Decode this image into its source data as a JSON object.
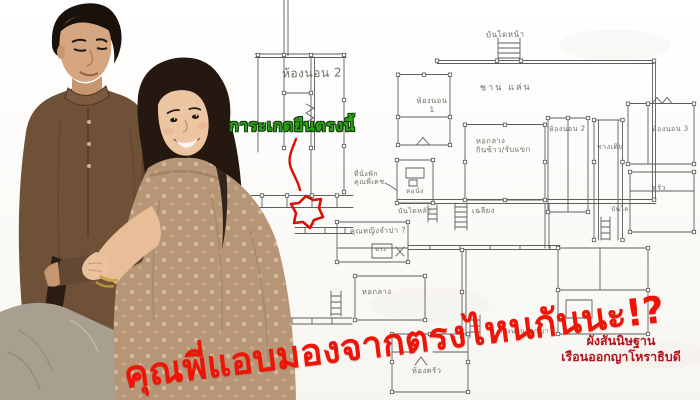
{
  "meme": {
    "caption": "คุณพี่แอบมองจากตรงไหนกันนะ!?",
    "spot_annotation": "การะเกดยืนตรงนี้",
    "credit": {
      "line1": "ผังสันนิษฐาน",
      "line2": "เรือนออกญาโหราธิบดี"
    }
  },
  "colors": {
    "caption_red": "#ee1407",
    "annotation_green": "#2fa316",
    "credit_dark_red": "#b4121b",
    "plan_ink": "#5e5e5e",
    "marker_red": "#d41108"
  },
  "floor_plan": {
    "labels": [
      {
        "text": "ห้องนอน 2",
        "x": 282,
        "y": 66,
        "s": 12
      },
      {
        "text": "บันไดหน้า",
        "x": 486,
        "y": 30,
        "s": 8
      },
      {
        "text": "ชาน แล่น",
        "x": 480,
        "y": 83,
        "s": 9,
        "ls": 2
      },
      {
        "text": "ห้องนอน\n1",
        "x": 414,
        "y": 96,
        "s": 7.5,
        "w": 36,
        "align": "center"
      },
      {
        "text": "หอกลาง\nกินข้าว/รับแขก",
        "x": 476,
        "y": 136,
        "s": 7.5
      },
      {
        "text": "ห้องนอน 2",
        "x": 549,
        "y": 125,
        "s": 7
      },
      {
        "text": "ทางเดิน",
        "x": 597,
        "y": 143,
        "s": 7
      },
      {
        "text": "ห้องนอน 3",
        "x": 652,
        "y": 125,
        "s": 7
      },
      {
        "text": "ครัว",
        "x": 652,
        "y": 184,
        "s": 7
      },
      {
        "text": "เฉลียง",
        "x": 472,
        "y": 206,
        "s": 7.5
      },
      {
        "text": "บันไดหลัง",
        "x": 398,
        "y": 207,
        "s": 7
      },
      {
        "text": "ที่นั่งพัก\nคุณพี่เดช",
        "x": 354,
        "y": 170,
        "s": 7
      },
      {
        "text": "หอนั่ง",
        "x": 406,
        "y": 188,
        "s": 6.5
      },
      {
        "text": "คุณหญิงจำปา ?",
        "x": 350,
        "y": 226,
        "s": 7.5
      },
      {
        "text": "พระ",
        "x": 375,
        "y": 246,
        "s": 6
      },
      {
        "text": "หอกลาง",
        "x": 362,
        "y": 287,
        "s": 7.5
      },
      {
        "text": "ห้องครัว",
        "x": 412,
        "y": 366,
        "s": 7.5
      },
      {
        "text": "ห้องนอนออกญา",
        "x": 498,
        "y": 328,
        "s": 6.5
      },
      {
        "text": "บันได",
        "x": 611,
        "y": 206,
        "s": 6.5
      }
    ]
  }
}
